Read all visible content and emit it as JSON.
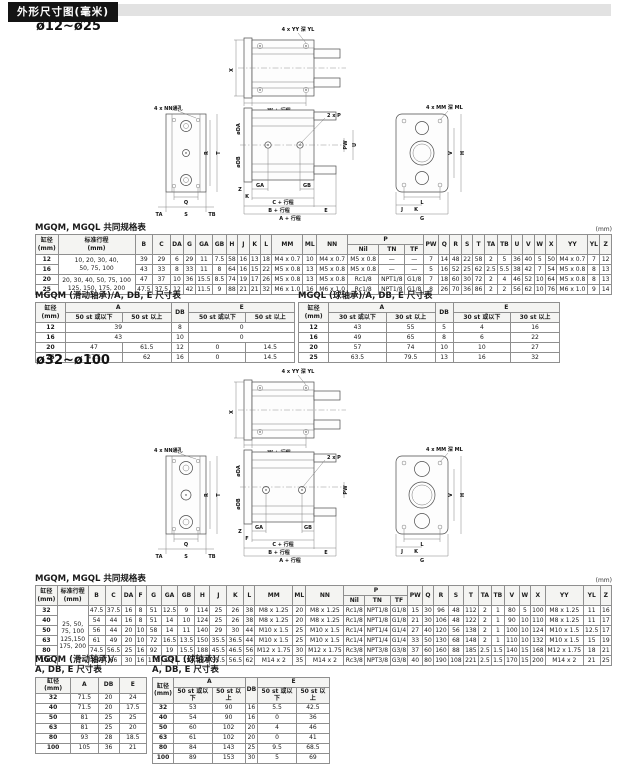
{
  "page": {
    "header_title": "外形尺寸图(毫米)",
    "section1_title": "ø12~ø25",
    "section2_title": "ø32~ø100"
  },
  "d1": {
    "yy": "4 x YY 深 YL",
    "x": "X",
    "z": "Z",
    "w": "W + 行程",
    "nn": "4 x NN通孔",
    "r": "R",
    "t": "T",
    "q": "Q",
    "s": "S",
    "ta": "TA",
    "tb": "TB",
    "p": "2 x P",
    "da": "øDA",
    "db": "øDB",
    "pw": "PW",
    "u": "U",
    "z2": "Z",
    "k": "K",
    "ga": "GA",
    "gb": "GB",
    "c": "C + 行程",
    "b": "B + 行程",
    "a": "A + 行程",
    "e": "E",
    "mm": "4 x MM 深 ML",
    "v": "V",
    "h": "H",
    "l": "L",
    "j": "J",
    "k2": "K",
    "g": "G"
  },
  "d2": {
    "yy": "4 x YY 深 YL",
    "x": "X",
    "z": "Z",
    "w": "W + 行程",
    "nn": "4 x NN通孔",
    "r": "R",
    "t": "T",
    "q": "Q",
    "s": "S",
    "ta": "TA",
    "tb": "TB",
    "p": "2 x P",
    "da": "øDA",
    "db": "øDB",
    "pw": "PW",
    "z2": "Z",
    "f": "F",
    "ga": "GA",
    "gb": "GB",
    "c": "C + 行程",
    "b": "B + 行程",
    "a": "A + 行程",
    "e": "E",
    "mm": "4 x MM 深 ML",
    "v": "V",
    "h": "H",
    "l": "L",
    "j": "J",
    "k2": "K",
    "g": "G"
  },
  "table1": {
    "title": "MGQM, MGQL 共同规格表",
    "unit": "(mm)",
    "header": [
      [
        {
          "t": "缸径\n(mm)",
          "rs": 2
        },
        {
          "t": "标准行程\n(mm)",
          "rs": 2
        },
        {
          "t": "B",
          "rs": 2
        },
        {
          "t": "C",
          "rs": 2
        },
        {
          "t": "DA",
          "rs": 2
        },
        {
          "t": "G",
          "rs": 2
        },
        {
          "t": "GA",
          "rs": 2
        },
        {
          "t": "GB",
          "rs": 2
        },
        {
          "t": "H",
          "rs": 2
        },
        {
          "t": "J",
          "rs": 2
        },
        {
          "t": "K",
          "rs": 2
        },
        {
          "t": "L",
          "rs": 2
        },
        {
          "t": "MM",
          "rs": 2
        },
        {
          "t": "ML",
          "rs": 2
        },
        {
          "t": "NN",
          "rs": 2
        },
        {
          "t": "P",
          "cs": 3
        },
        {
          "t": "PW",
          "rs": 2
        },
        {
          "t": "Q",
          "rs": 2
        },
        {
          "t": "R",
          "rs": 2
        },
        {
          "t": "S",
          "rs": 2
        },
        {
          "t": "T",
          "rs": 2
        },
        {
          "t": "TA",
          "rs": 2
        },
        {
          "t": "TB",
          "rs": 2
        },
        {
          "t": "U",
          "rs": 2
        },
        {
          "t": "V",
          "rs": 2
        },
        {
          "t": "W",
          "rs": 2
        },
        {
          "t": "X",
          "rs": 2
        },
        {
          "t": "YY",
          "rs": 2
        },
        {
          "t": "YL",
          "rs": 2
        },
        {
          "t": "Z",
          "rs": 2
        }
      ],
      [
        {
          "t": "Nil"
        },
        {
          "t": "TN"
        },
        {
          "t": "TF"
        }
      ]
    ],
    "rows": [
      [
        "12",
        {
          "t": "10, 20, 30, 40,\n50, 75, 100",
          "rs": 2
        },
        "39",
        "29",
        "6",
        "29",
        "11",
        "7.5",
        "58",
        "16",
        "13",
        "18",
        "M4 x 0.7",
        "10",
        "M4 x 0.7",
        "M5 x 0.8",
        "—",
        "—",
        "7",
        "14",
        "48",
        "22",
        "58",
        "2",
        "5",
        "36",
        "40",
        "5",
        "50",
        "M4 x 0.7",
        "7",
        "12"
      ],
      [
        "16",
        "43",
        "33",
        "8",
        "33",
        "11",
        "8",
        "64",
        "16",
        "15",
        "22",
        "M5 x 0.8",
        "13",
        "M5 x 0.8",
        "M5 x 0.8",
        "—",
        "—",
        "5",
        "16",
        "52",
        "25",
        "62",
        "2.5",
        "5.5",
        "38",
        "42",
        "7",
        "54",
        "M5 x 0.8",
        "8",
        "13"
      ],
      [
        "20",
        {
          "t": "20, 30, 40, 50, 75, 100\n125, 150, 175, 200",
          "rs": 2
        },
        "47",
        "37",
        "10",
        "36",
        "15.5",
        "8.5",
        "74",
        "19",
        "17",
        "26",
        "M5 x 0.8",
        "13",
        "M5 x 0.8",
        "Rc1/8",
        "NPT1/8",
        "G1/8",
        "7",
        "18",
        "60",
        "30",
        "72",
        "2",
        "4",
        "46",
        "52",
        "10",
        "64",
        "M5 x 0.8",
        "8",
        "13"
      ],
      [
        "25",
        "47.5",
        "37.5",
        "12",
        "42",
        "11.5",
        "9",
        "88",
        "21",
        "21",
        "32",
        "M6 x 1.0",
        "16",
        "M6 x 1.0",
        "Rc1/8",
        "NPT1/8",
        "G1/8",
        "8",
        "26",
        "70",
        "36",
        "86",
        "2",
        "2",
        "56",
        "62",
        "10",
        "76",
        "M6 x 1.0",
        "9",
        "14"
      ]
    ]
  },
  "tableM1": {
    "title": "MGQM (滑动轴承)/A, DB, E 尺寸表",
    "header": [
      [
        {
          "t": "缸径\n(mm)",
          "rs": 2
        },
        {
          "t": "A",
          "cs": 2
        },
        {
          "t": "DB",
          "rs": 2
        },
        {
          "t": "E",
          "cs": 2
        }
      ],
      [
        {
          "t": "50 st 或以下"
        },
        {
          "t": "50 st 以上"
        },
        {
          "t": "50 st 或以下"
        },
        {
          "t": "50 st 以上"
        }
      ]
    ],
    "rows": [
      [
        "12",
        {
          "t": "39",
          "cs": 2
        },
        "8",
        {
          "t": "0",
          "cs": 2
        }
      ],
      [
        "16",
        {
          "t": "43",
          "cs": 2
        },
        "10",
        {
          "t": "0",
          "cs": 2
        }
      ],
      [
        "20",
        "47",
        "61.5",
        "12",
        "0",
        "14.5"
      ],
      [
        "25",
        "47.5",
        "62",
        "16",
        "0",
        "14.5"
      ]
    ]
  },
  "tableL1": {
    "title": "MGQL (球轴承)/A, DB, E 尺寸表",
    "header": [
      [
        {
          "t": "缸径\n(mm)",
          "rs": 2
        },
        {
          "t": "A",
          "cs": 2
        },
        {
          "t": "DB",
          "rs": 2
        },
        {
          "t": "E",
          "cs": 2
        }
      ],
      [
        {
          "t": "30 st 或以下"
        },
        {
          "t": "30 st 以上"
        },
        {
          "t": "30 st 或以下"
        },
        {
          "t": "30 st 以上"
        }
      ]
    ],
    "rows": [
      [
        "12",
        "43",
        "55",
        "5",
        "4",
        "16"
      ],
      [
        "16",
        "49",
        "65",
        "8",
        "6",
        "22"
      ],
      [
        "20",
        "57",
        "74",
        "10",
        "10",
        "27"
      ],
      [
        "25",
        "63.5",
        "79.5",
        "13",
        "16",
        "32"
      ]
    ]
  },
  "table2": {
    "title": "MGQM, MGQL 共同规格表",
    "unit": "(mm)",
    "header": [
      [
        {
          "t": "缸径\n(mm)",
          "rs": 2
        },
        {
          "t": "标准行程\n(mm)",
          "rs": 2
        },
        {
          "t": "B",
          "rs": 2
        },
        {
          "t": "C",
          "rs": 2
        },
        {
          "t": "DA",
          "rs": 2
        },
        {
          "t": "F",
          "rs": 2
        },
        {
          "t": "G",
          "rs": 2
        },
        {
          "t": "GA",
          "rs": 2
        },
        {
          "t": "GB",
          "rs": 2
        },
        {
          "t": "H",
          "rs": 2
        },
        {
          "t": "J",
          "rs": 2
        },
        {
          "t": "K",
          "rs": 2
        },
        {
          "t": "L",
          "rs": 2
        },
        {
          "t": "MM",
          "rs": 2
        },
        {
          "t": "ML",
          "rs": 2
        },
        {
          "t": "NN",
          "rs": 2
        },
        {
          "t": "P",
          "cs": 3
        },
        {
          "t": "PW",
          "rs": 2
        },
        {
          "t": "Q",
          "rs": 2
        },
        {
          "t": "R",
          "rs": 2
        },
        {
          "t": "S",
          "rs": 2
        },
        {
          "t": "T",
          "rs": 2
        },
        {
          "t": "TA",
          "rs": 2
        },
        {
          "t": "TB",
          "rs": 2
        },
        {
          "t": "V",
          "rs": 2
        },
        {
          "t": "W",
          "rs": 2
        },
        {
          "t": "X",
          "rs": 2
        },
        {
          "t": "YY",
          "rs": 2
        },
        {
          "t": "YL",
          "rs": 2
        },
        {
          "t": "Z",
          "rs": 2
        }
      ],
      [
        {
          "t": "Nil"
        },
        {
          "t": "TN"
        },
        {
          "t": "TF"
        }
      ]
    ],
    "rows": [
      [
        "32",
        {
          "t": "25, 50,\n75, 100\n125,150\n175, 200",
          "rs": 6
        },
        "47.5",
        "37.5",
        "16",
        "8",
        "51",
        "12.5",
        "9",
        "114",
        "25",
        "26",
        "38",
        "M8 x 1.25",
        "20",
        "M8 x 1.25",
        "Rc1/8",
        "NPT1/8",
        "G1/8",
        "15",
        "30",
        "96",
        "48",
        "112",
        "2",
        "1",
        "80",
        "5",
        "100",
        "M8 x 1.25",
        "11",
        "16"
      ],
      [
        "40",
        "54",
        "44",
        "16",
        "8",
        "51",
        "14",
        "10",
        "124",
        "25",
        "26",
        "38",
        "M8 x 1.25",
        "20",
        "M8 x 1.25",
        "Rc1/8",
        "NPT1/8",
        "G1/8",
        "21",
        "30",
        "106",
        "48",
        "122",
        "2",
        "1",
        "90",
        "10",
        "110",
        "M8 x 1.25",
        "11",
        "17"
      ],
      [
        "50",
        "56",
        "44",
        "20",
        "10",
        "58",
        "14",
        "11",
        "140",
        "29",
        "30",
        "44",
        "M10 x 1.5",
        "25",
        "M10 x 1.5",
        "Rc1/4",
        "NPT1/4",
        "G1/4",
        "27",
        "40",
        "120",
        "56",
        "138",
        "2",
        "1",
        "100",
        "10",
        "124",
        "M10 x 1.5",
        "12.5",
        "17"
      ],
      [
        "63",
        "61",
        "49",
        "20",
        "10",
        "72",
        "16.5",
        "13.5",
        "150",
        "35.5",
        "36.5",
        "44",
        "M10 x 1.5",
        "25",
        "M10 x 1.5",
        "Rc1/4",
        "NPT1/4",
        "G1/4",
        "33",
        "50",
        "130",
        "68",
        "148",
        "2",
        "1",
        "110",
        "10",
        "132",
        "M10 x 1.5",
        "15",
        "19"
      ],
      [
        "80",
        "74.5",
        "56.5",
        "25",
        "16",
        "92",
        "19",
        "15.5",
        "188",
        "45.5",
        "46.5",
        "56",
        "M12 x 1.75",
        "30",
        "M12 x 1.75",
        "Rc3/8",
        "NPT3/8",
        "G3/8",
        "37",
        "60",
        "160",
        "88",
        "185",
        "2.5",
        "1.5",
        "140",
        "15",
        "168",
        "M12 x 1.75",
        "18",
        "21"
      ],
      [
        "100",
        "84",
        "66",
        "30",
        "16",
        "112",
        "23",
        "19",
        "224",
        "55.5",
        "56.5",
        "62",
        "M14 x 2",
        "35",
        "M14 x 2",
        "Rc3/8",
        "NPT3/8",
        "G3/8",
        "40",
        "80",
        "190",
        "108",
        "221",
        "2.5",
        "1.5",
        "170",
        "15",
        "200",
        "M14 x 2",
        "21",
        "25"
      ]
    ]
  },
  "tableM2": {
    "title1": "MGQM (滑动轴承)/",
    "title2": "A, DB, E 尺寸表",
    "header": [
      [
        {
          "t": "缸径\n(mm)"
        },
        {
          "t": "A"
        },
        {
          "t": "DB"
        },
        {
          "t": "E"
        }
      ]
    ],
    "rows": [
      [
        "32",
        "71.5",
        "20",
        "24"
      ],
      [
        "40",
        "71.5",
        "20",
        "17.5"
      ],
      [
        "50",
        "81",
        "25",
        "25"
      ],
      [
        "63",
        "81",
        "25",
        "20"
      ],
      [
        "80",
        "93",
        "28",
        "18.5"
      ],
      [
        "100",
        "105",
        "36",
        "21"
      ]
    ]
  },
  "tableL2": {
    "title1": "MGQL (球轴承)/",
    "title2": "A, DB, E 尺寸表",
    "header": [
      [
        {
          "t": "缸径\n(mm)",
          "rs": 2
        },
        {
          "t": "A",
          "cs": 2
        },
        {
          "t": "DB",
          "rs": 2
        },
        {
          "t": "E",
          "cs": 2
        }
      ],
      [
        {
          "t": "50 st 或以下"
        },
        {
          "t": "50 st 以上"
        },
        {
          "t": "50 st 或以下"
        },
        {
          "t": "50 st 以上"
        }
      ]
    ],
    "rows": [
      [
        "32",
        "53",
        "90",
        "16",
        "5.5",
        "42.5"
      ],
      [
        "40",
        "54",
        "90",
        "16",
        "0",
        "36"
      ],
      [
        "50",
        "60",
        "102",
        "20",
        "4",
        "46"
      ],
      [
        "63",
        "61",
        "102",
        "20",
        "0",
        "41"
      ],
      [
        "80",
        "84",
        "143",
        "25",
        "9.5",
        "68.5"
      ],
      [
        "100",
        "89",
        "153",
        "30",
        "5",
        "69"
      ]
    ]
  }
}
